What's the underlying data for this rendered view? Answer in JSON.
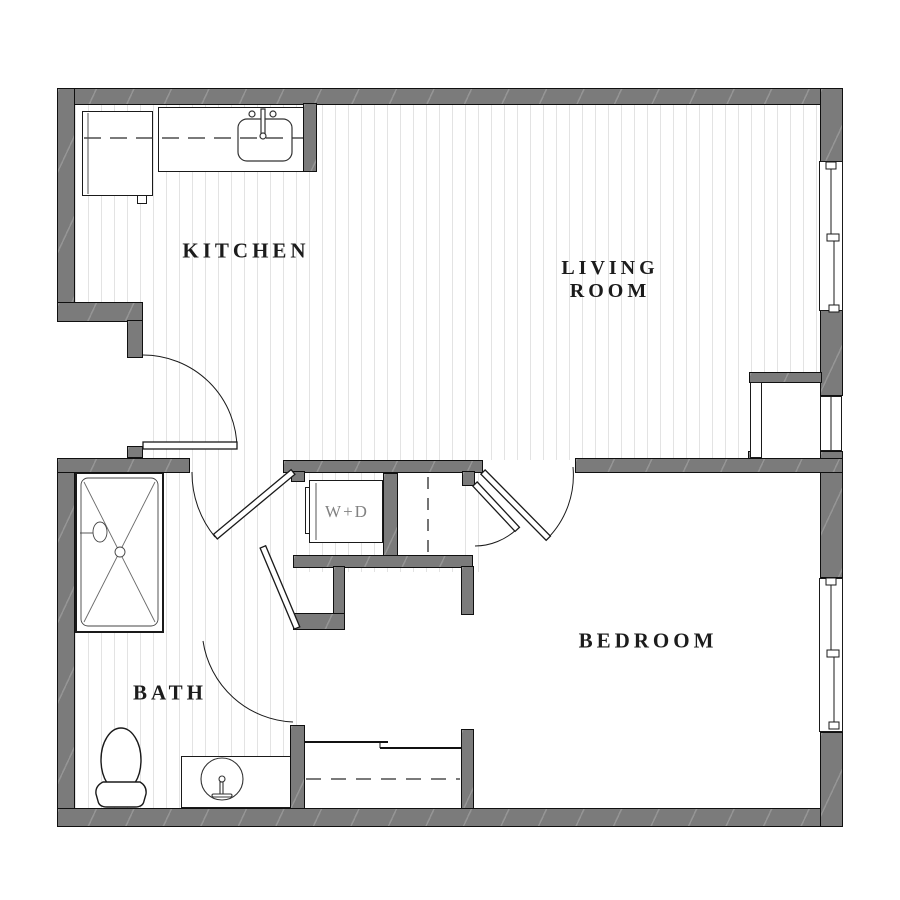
{
  "plan": {
    "type": "apartment-floor-plan",
    "labels": {
      "kitchen": "KITCHEN",
      "living_line1": "LIVING",
      "living_line2": "ROOM",
      "bedroom": "BEDROOM",
      "bath": "BATH",
      "washer_dryer": "W+D"
    },
    "colors": {
      "wall": "#7b7b7b",
      "wall_outline": "#101010",
      "floor_stripe": "#e3e3e3",
      "room_label": "#1c1c1c",
      "wd_label": "#828282",
      "background": "#ffffff"
    },
    "fixtures": [
      "refrigerator",
      "kitchen-counter",
      "kitchen-sink",
      "washer-dryer",
      "linen-closet",
      "shower",
      "toilet",
      "bathroom-vanity",
      "bedroom-closet"
    ],
    "windows": [
      "living-room-window",
      "nook-left-window",
      "nook-right-window",
      "bedroom-window"
    ],
    "doors": [
      "kitchen-entry-door",
      "laundry-left-door",
      "laundry-right-door",
      "bedroom-door",
      "bath-door"
    ]
  }
}
